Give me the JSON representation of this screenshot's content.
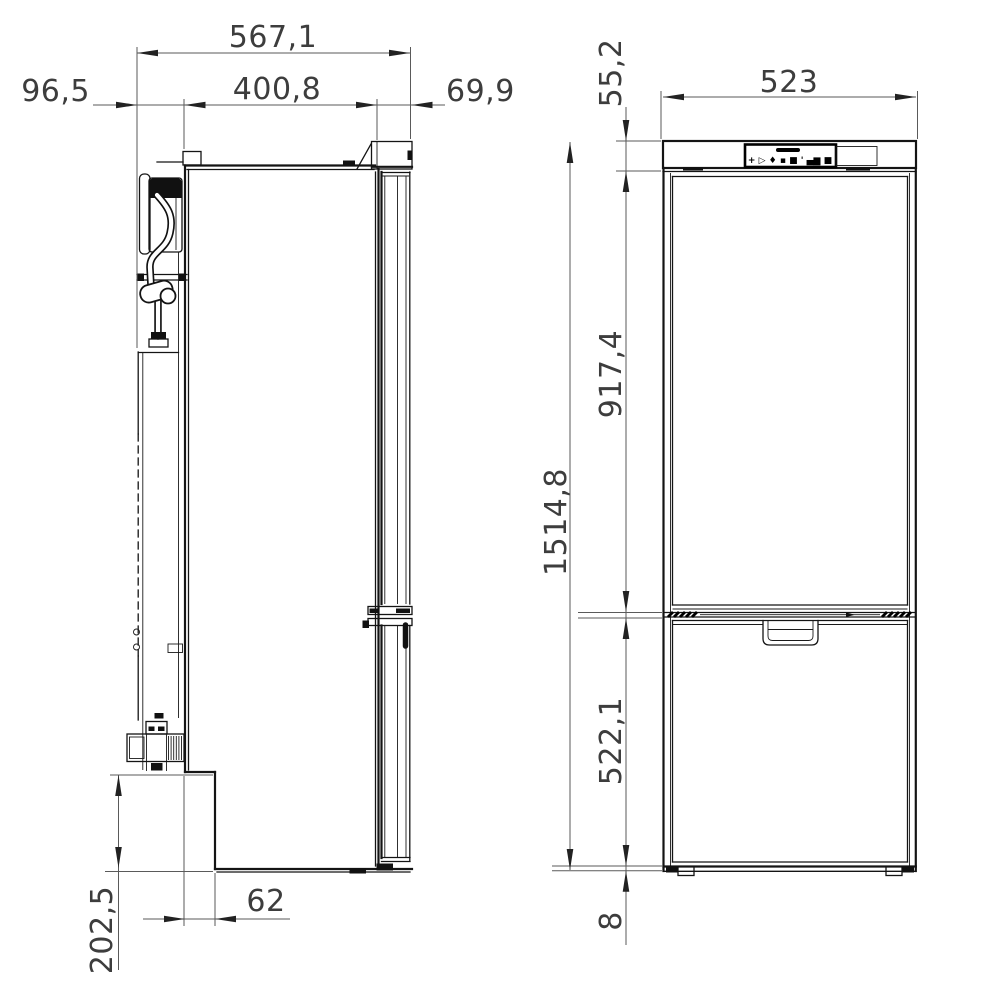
{
  "drawing": {
    "side_view": {
      "dim_overall_depth": "567,1",
      "dim_body_depth": "400,8",
      "dim_cooling_unit_depth": "96,5",
      "dim_door_thickness": "69,9",
      "dim_recess_height": "202,5",
      "dim_recess_depth": "62"
    },
    "front_view": {
      "dim_top_panel_height": "55,2",
      "dim_width": "523",
      "dim_upper_door_height": "917,4",
      "dim_overall_height": "1514,8",
      "dim_lower_door_height": "522,1",
      "dim_bottom_clearance": "8",
      "control_panel_icons": "+ ▷ ♦ ▪ ■  ' ▄▆ ■"
    }
  }
}
